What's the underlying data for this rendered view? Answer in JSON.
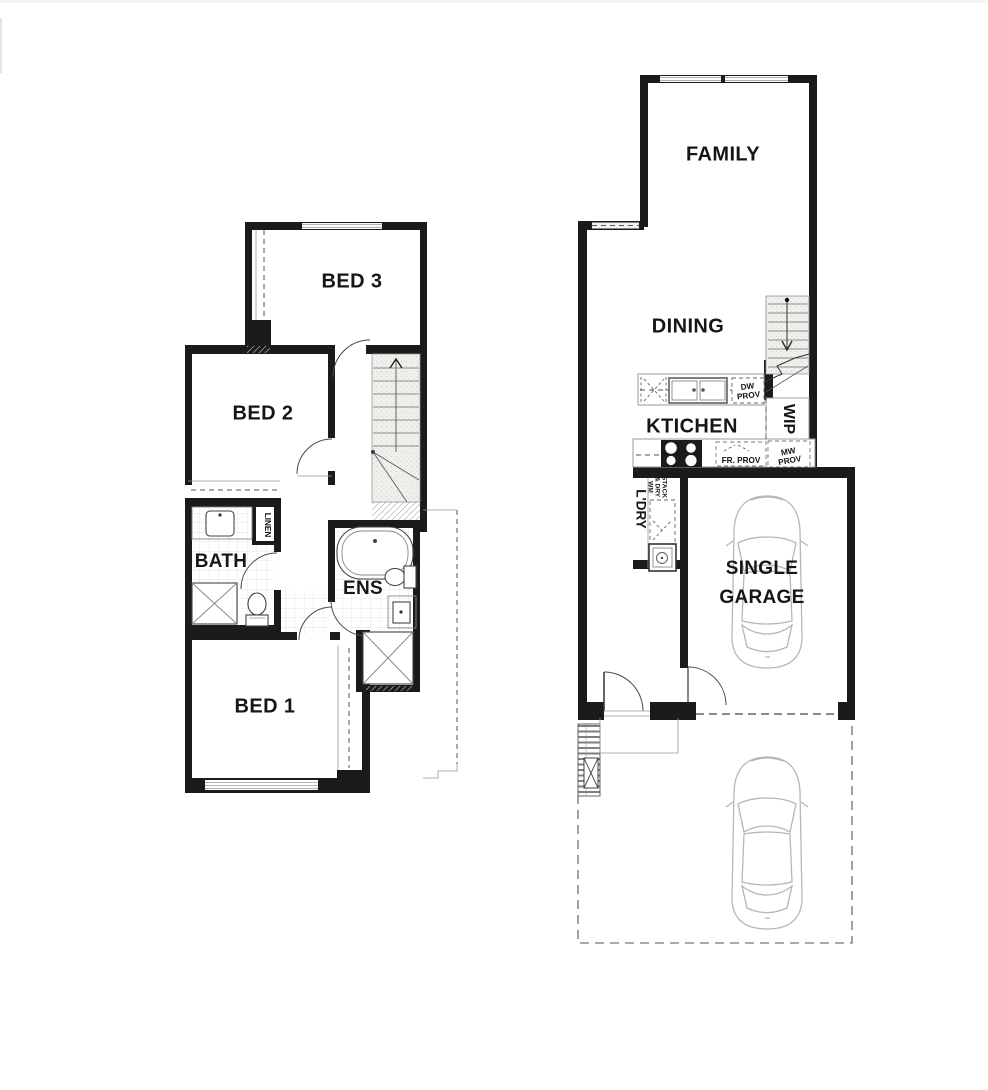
{
  "document": {
    "kind": "architectural floor plan",
    "background": "#ffffff"
  },
  "colors": {
    "wall": "#1b1b1b",
    "line": "#4a4a4a",
    "fixture": "#777777",
    "car_outline": "#b6b6b6",
    "tile": "#dddddd"
  },
  "upper_floor": {
    "bed3": "BED 3",
    "bed2": "BED 2",
    "bath": "BATH",
    "linen": "LINEN",
    "ens": "ENS",
    "bed1": "BED 1"
  },
  "ground_floor": {
    "family": "FAMILY",
    "dining": "DINING",
    "kitchen": "KTICHEN",
    "wip": "WIP",
    "laundry": "L'DRY",
    "garage_line1": "SINGLE",
    "garage_line2": "GARAGE",
    "dw_line1": "DW",
    "dw_line2": "PROV",
    "fr_prov": "FR. PROV",
    "mw_line1": "MW",
    "mw_line2": "PROV",
    "stack_line1": "WM",
    "stack_line2": "& DRY",
    "stack_line3": "STACK"
  }
}
